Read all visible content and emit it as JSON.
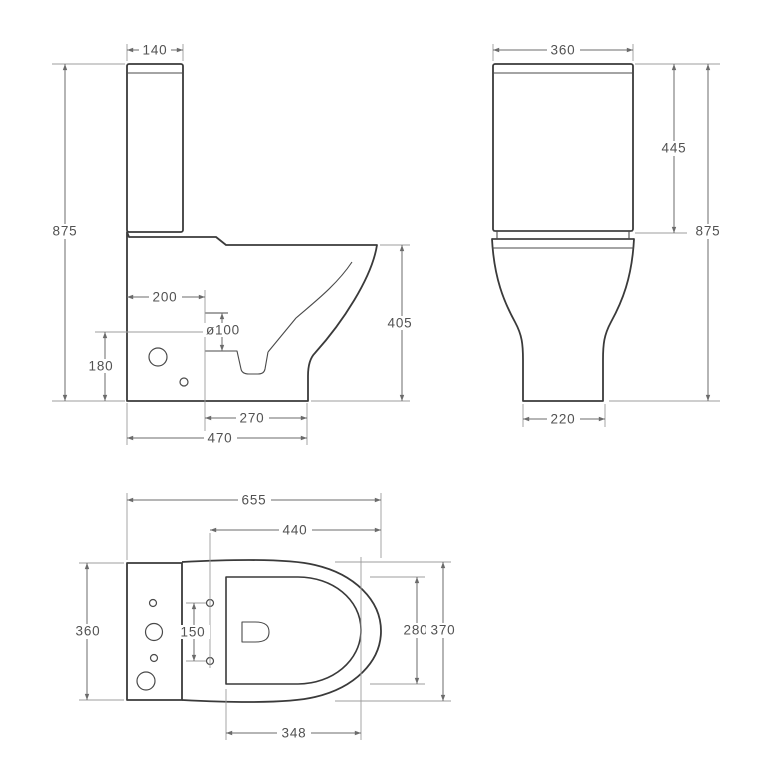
{
  "drawing": {
    "title": "toilet-dimension-drawing",
    "background": "#ffffff",
    "outline_color": "#3a3a3a",
    "dimension_line_color": "#6b6b6b",
    "dimension_text_color": "#525252",
    "views": {
      "side": {
        "dims": {
          "tank_width": "140",
          "total_height": "875",
          "outlet_setback": "200",
          "outlet_diameter": "ø100",
          "outlet_center_height": "180",
          "rim_height": "405",
          "outlet_to_front": "270",
          "depth": "470"
        }
      },
      "front": {
        "dims": {
          "tank_width": "360",
          "tank_height": "445",
          "total_height": "875",
          "foot_width": "220"
        }
      },
      "plan": {
        "dims": {
          "overall_depth": "655",
          "seat_length": "440",
          "width": "360",
          "hinge_hole_spacing": "150",
          "bowl_inner_width": "280",
          "bowl_outer_width": "370",
          "bowl_inner_length": "348"
        }
      }
    }
  }
}
